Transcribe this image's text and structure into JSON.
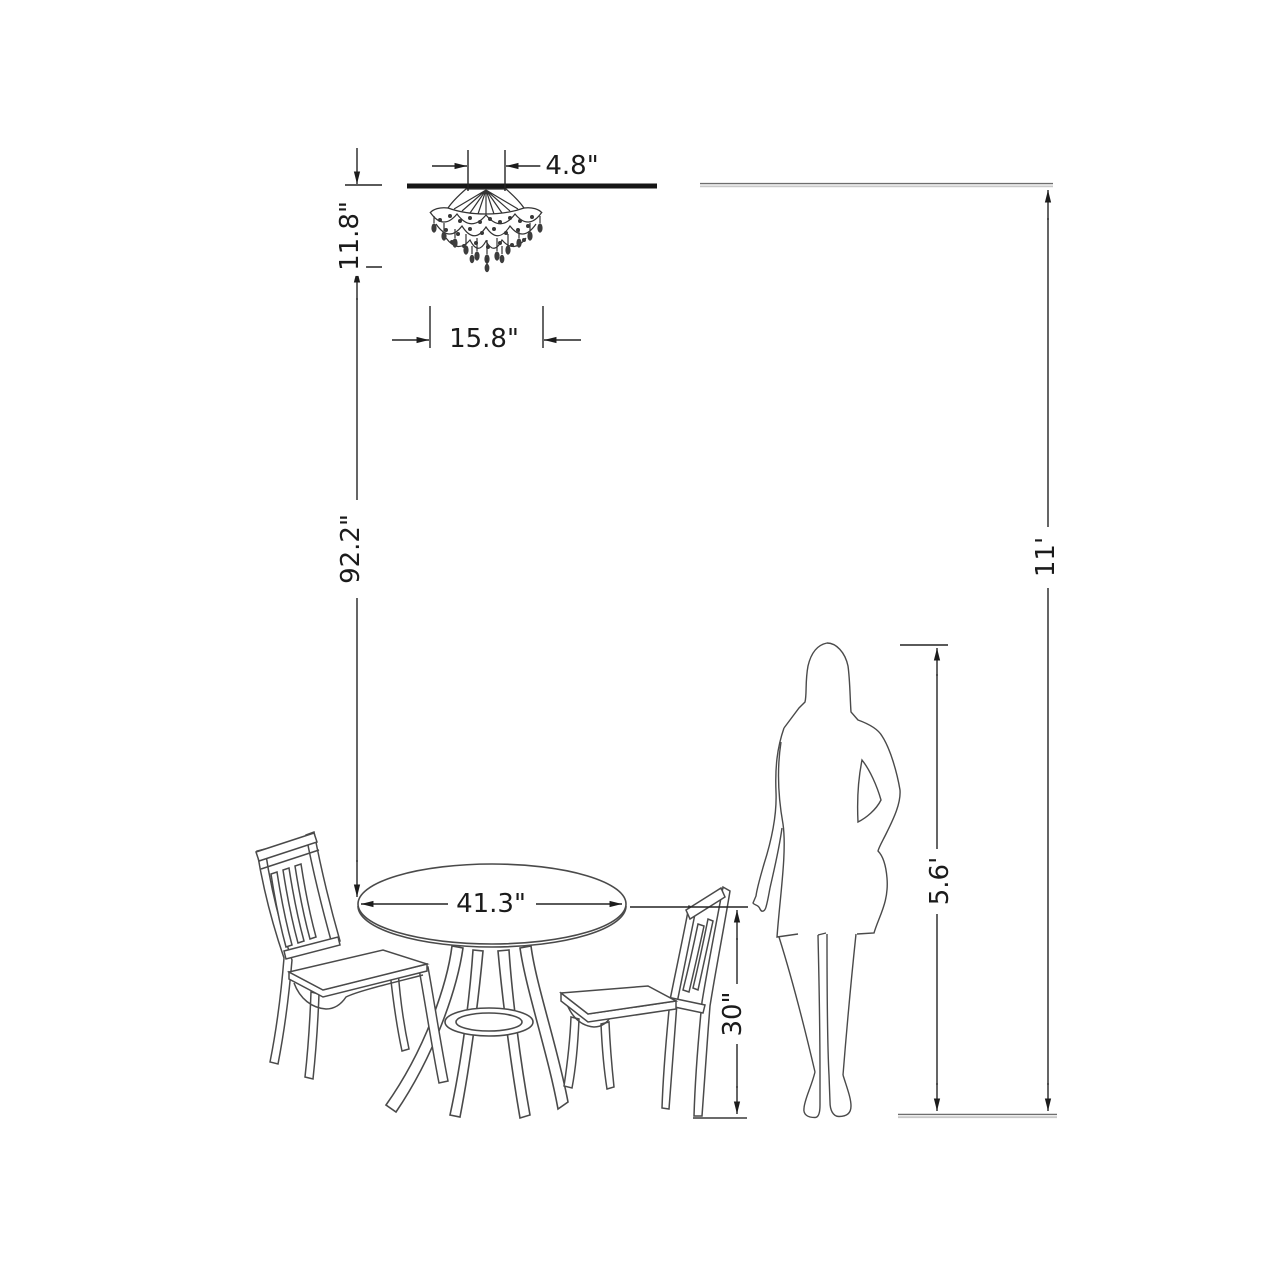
{
  "diagram": {
    "type": "product-dimension-diagram",
    "scene": [
      "crystal chandelier on ceiling",
      "round pedestal dining table",
      "left slat-back chair",
      "right slat-back chair",
      "standing woman silhouette"
    ],
    "colors": {
      "background": "#ffffff",
      "artwork_line": "#4a4a4a",
      "dimension_line": "#242424",
      "label_text": "#1b1b1b",
      "ceiling_line": "#161616",
      "guide_line": "#9e9e9e"
    }
  },
  "dims": {
    "canopy_width": "4.8\"",
    "chandelier_height": "11.8\"",
    "chandelier_width": "15.8\"",
    "chandelier_to_table": "92.2\"",
    "table_diameter": "41.3\"",
    "table_height": "30\"",
    "person_height": "5.6'",
    "ceiling_height": "11'"
  }
}
